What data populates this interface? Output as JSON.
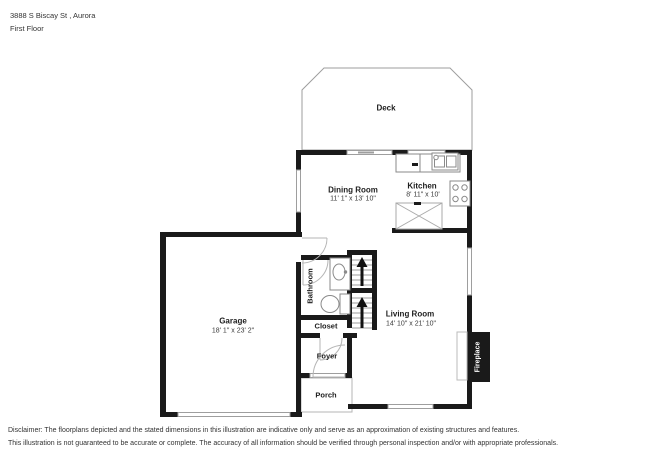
{
  "header": {
    "address": "3888 S Biscay St , Aurora",
    "floor": "First Floor"
  },
  "rooms": {
    "deck": {
      "name": "Deck"
    },
    "dining": {
      "name": "Dining Room",
      "dims": "11' 1\" x 13' 10\""
    },
    "kitchen": {
      "name": "Kitchen",
      "dims": "8' 11\" x 10'"
    },
    "garage": {
      "name": "Garage",
      "dims": "18' 1\" x 23' 2\""
    },
    "living": {
      "name": "Living Room",
      "dims": "14' 10\" x 21' 10\""
    },
    "bathroom": {
      "name": "Bathroom"
    },
    "closet": {
      "name": "Closet"
    },
    "foyer": {
      "name": "Foyer"
    },
    "porch": {
      "name": "Porch"
    },
    "fireplace": {
      "name": "Fireplace"
    }
  },
  "disclaimer": {
    "line1": "Disclaimer: The floorplans depicted and the stated dimensions in this illustration are indicative only and serve as an approximation of existing structures and features.",
    "line2": "This illustration is not guaranteed to be accurate or complete. The accuracy of all information should be verified through personal inspection and/or with appropriate professionals."
  },
  "colors": {
    "wall": "#1a1a1a",
    "thin_line": "#9e9e9e",
    "fixture_line": "#8a8a8a",
    "label_text": "#1d1d1d"
  }
}
